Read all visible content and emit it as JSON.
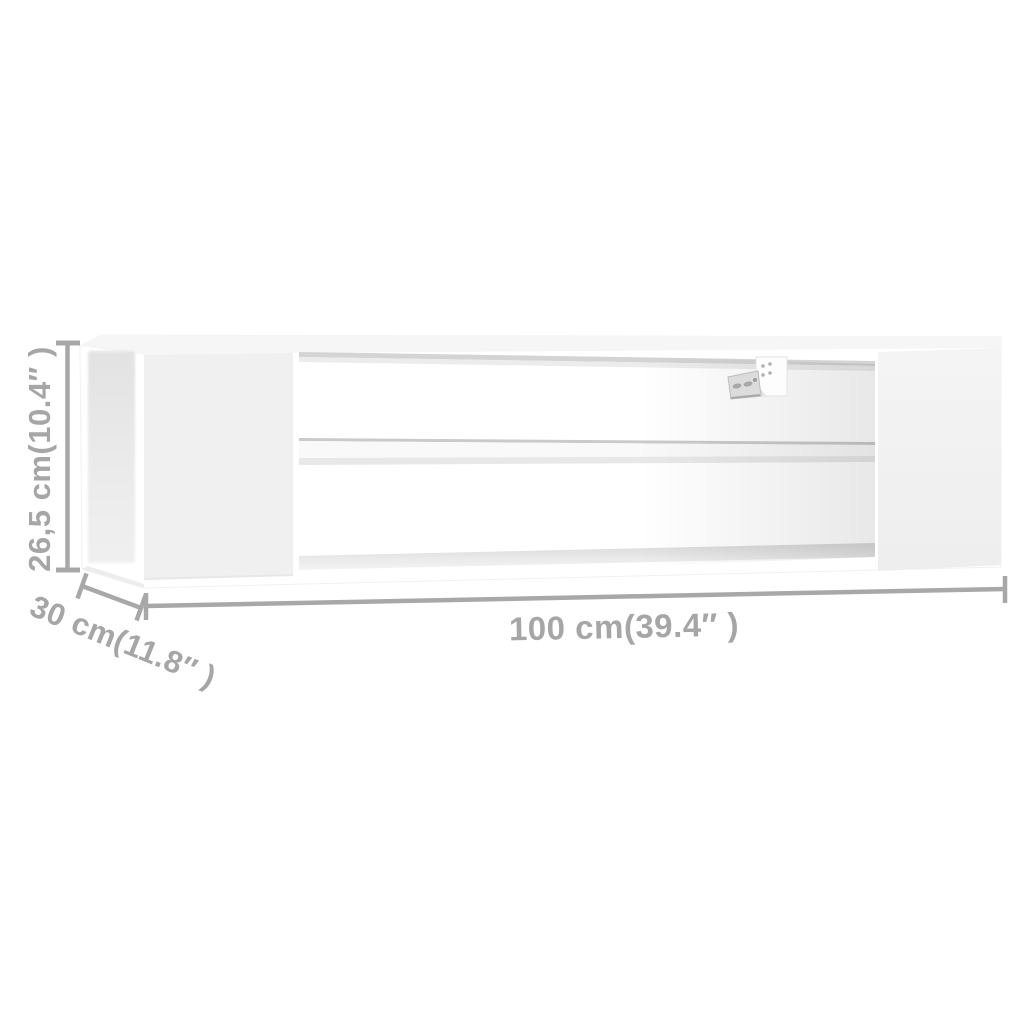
{
  "diagram": {
    "colors": {
      "background": "#ffffff",
      "annotation": "#a8a8a8",
      "furniture": "#ffffff",
      "furniture_shadow": "#f0f0f0",
      "inner_edge": "#d4d4d4"
    },
    "dimensions": {
      "height": {
        "label": "26,5 cm(10.4″ )"
      },
      "depth": {
        "label": "30 cm(11.8″ )"
      },
      "width": {
        "label": "100 cm(39.4″ )"
      }
    }
  }
}
